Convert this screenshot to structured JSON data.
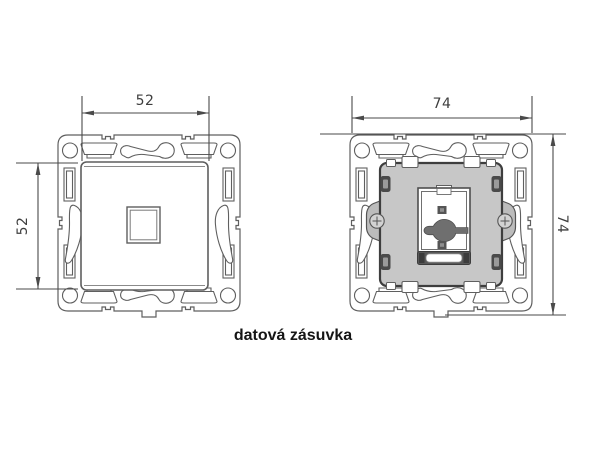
{
  "caption": "datová zásuvka",
  "views": {
    "front": {
      "name": "front view with cover plate",
      "width_label": "52",
      "height_label": "52"
    },
    "mechanism": {
      "name": "mounting frame with socket mechanism",
      "width_label": "74",
      "height_label": "74"
    }
  },
  "colors": {
    "background": "#ffffff",
    "outline": "#5f5f5f",
    "dimension": "#4a4a4a",
    "mechanism_fill": "#c7c7c7",
    "dark_detail": "#4a4a4a",
    "keyhole": "#6f6f6f",
    "caption_text": "#151515"
  }
}
